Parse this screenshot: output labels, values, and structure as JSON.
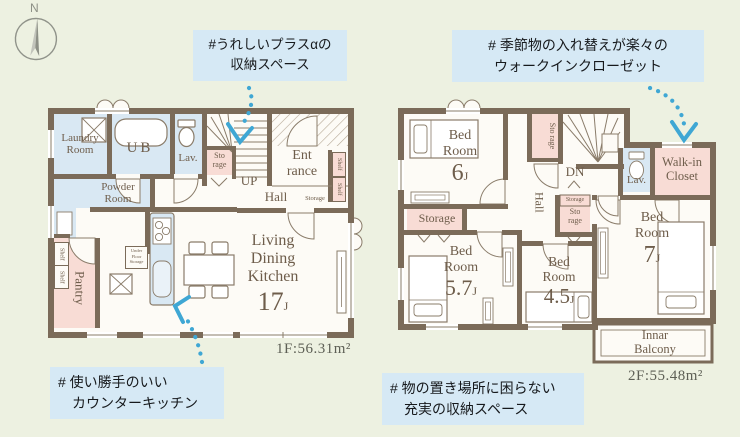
{
  "compass": {
    "north_label": "N"
  },
  "callouts": [
    {
      "id": "plus-storage",
      "lines": [
        "#うれしいプラスαの",
        "収納スペース"
      ]
    },
    {
      "id": "walkin-closet",
      "lines": [
        "# 季節物の入れ替えが楽々の",
        "ウォークインクローゼット"
      ]
    },
    {
      "id": "counter-kitchen",
      "lines": [
        "# 使い勝手のいい",
        "カウンターキッチン"
      ]
    },
    {
      "id": "rich-storage",
      "lines": [
        "# 物の置き場所に困らない",
        "充実の収納スペース"
      ]
    }
  ],
  "floor1": {
    "area": "1F:56.31m²",
    "labels": {
      "laundry1": "Laundry",
      "laundry2": "Room",
      "ub": "UB",
      "lav": "Lav.",
      "sto1": "Sto",
      "sto2": "rage",
      "up": "UP",
      "ent1": "Ent",
      "ent2": "rance",
      "hall": "Hall",
      "storage_small": "Storage",
      "shelf": "Shelf",
      "powder1": "Powder",
      "powder2": "Room",
      "pantry": "Pantry",
      "ufs1": "Under",
      "ufs2": "Floor",
      "ufs3": "Storage",
      "ldk1": "Living",
      "ldk2": "Dining",
      "ldk3": "Kitchen",
      "ldk_size": "17",
      "unit": "J"
    }
  },
  "floor2": {
    "area": "2F:55.48m²",
    "labels": {
      "bed1": "Bed",
      "bed2": "Room",
      "bed6_size": "6",
      "bed57_size": "5.7",
      "bed45_size": "4.5",
      "bed7_size": "7",
      "unit": "J",
      "sto1": "Sto",
      "sto2": "rage",
      "dn": "DN",
      "hall": "Hall",
      "lav": "Lav.",
      "wic1": "Walk-in",
      "wic2": "Closet",
      "storage": "Storage",
      "balcony1": "Innar",
      "balcony2": "Balcony"
    }
  },
  "colors": {
    "background": "#edf1e1",
    "wall": "#7b6b59",
    "room_blue": "#d9e8f3",
    "room_pink": "#f8dcd5",
    "room_white": "#fdfbf6",
    "label_text": "#6e5d4b",
    "callout_bg": "#d6e9f5",
    "arrow": "#3fa7d4"
  }
}
